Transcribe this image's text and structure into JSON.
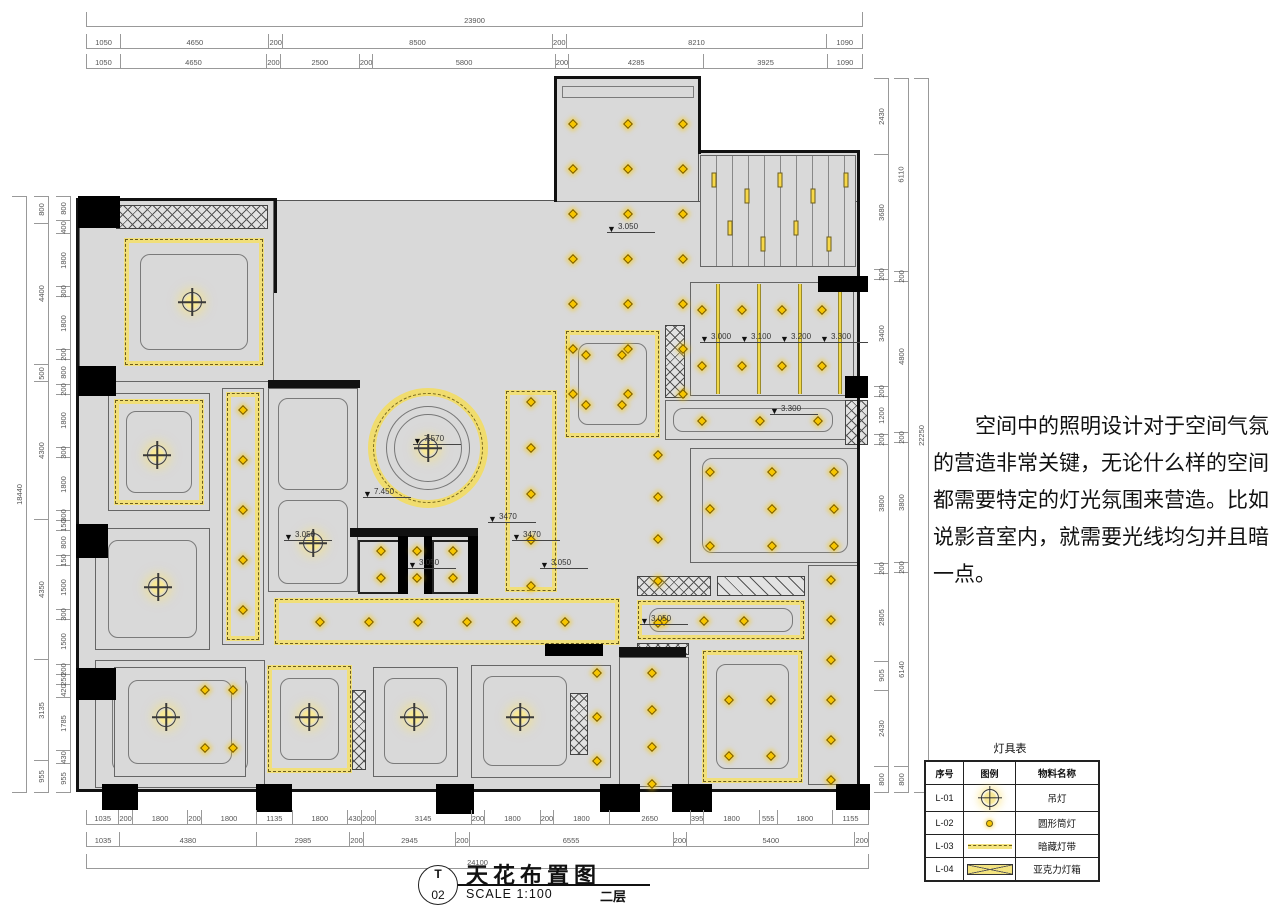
{
  "title_block": {
    "sheet_letter": "T",
    "sheet_number": "02",
    "title": "天花布置图",
    "scale": "SCALE 1:100",
    "floor": "二层"
  },
  "note": {
    "text": "空间中的照明设计对于空间气氛的营造非常关键，无论什么样的空间都需要特定的灯光氛围来营造。比如说影音室内，就需要光线均匀并且暗一点。"
  },
  "legend": {
    "title": "灯具表",
    "headers": [
      "序号",
      "图例",
      "物料名称"
    ],
    "rows": [
      {
        "id": "L-01",
        "symbol": "pendant-light",
        "name": "吊灯"
      },
      {
        "id": "L-02",
        "symbol": "round-downlight",
        "name": "圆形筒灯"
      },
      {
        "id": "L-03",
        "symbol": "concealed-light-strip",
        "name": "暗藏灯带"
      },
      {
        "id": "L-04",
        "symbol": "acrylic-light-box",
        "name": "亚克力灯箱"
      }
    ]
  },
  "dimensions": {
    "top": {
      "total": "23900",
      "row2": [
        1050,
        4650,
        200,
        8500,
        200,
        8210,
        1090
      ],
      "row3": [
        1050,
        4650,
        200,
        2500,
        200,
        5800,
        200,
        4285,
        3925,
        1090
      ]
    },
    "bottom": {
      "row1": [
        1035,
        200,
        1800,
        200,
        1800,
        1135,
        1800,
        430,
        200,
        3145,
        200,
        1800,
        200,
        1800,
        2650,
        395,
        1800,
        555,
        1800,
        1155
      ],
      "row2": [
        1035,
        4380,
        2985,
        200,
        2945,
        200,
        6555,
        200,
        5400,
        200
      ],
      "total": "24100"
    },
    "left": {
      "total": "18440",
      "mid": [
        800,
        4400,
        500,
        4300,
        4350,
        3135,
        955
      ],
      "inner": [
        800,
        400,
        1800,
        300,
        1800,
        200,
        800,
        200,
        1800,
        300,
        1800,
        300,
        150,
        800,
        150,
        1500,
        300,
        1500,
        200,
        250,
        420,
        1785,
        430,
        955
      ]
    },
    "right": {
      "total": "22250",
      "mid": [
        6110,
        200,
        4800,
        200,
        3800,
        200,
        6140,
        800
      ],
      "inner": [
        2430,
        3680,
        200,
        3400,
        200,
        1200,
        200,
        3800,
        200,
        2805,
        905,
        2430,
        800
      ]
    }
  },
  "plan": {
    "elevation_markers": [
      {
        "x": 607,
        "y": 222,
        "label": "3.050"
      },
      {
        "x": 413,
        "y": 434,
        "label": "7.570"
      },
      {
        "x": 363,
        "y": 487,
        "label": "7.450"
      },
      {
        "x": 284,
        "y": 530,
        "label": "3.050"
      },
      {
        "x": 408,
        "y": 558,
        "label": "3.050"
      },
      {
        "x": 488,
        "y": 512,
        "label": "3470"
      },
      {
        "x": 512,
        "y": 530,
        "label": "3470"
      },
      {
        "x": 540,
        "y": 558,
        "label": "3.050"
      },
      {
        "x": 700,
        "y": 332,
        "label": "3.000"
      },
      {
        "x": 740,
        "y": 332,
        "label": "3.100"
      },
      {
        "x": 780,
        "y": 332,
        "label": "3.200"
      },
      {
        "x": 820,
        "y": 332,
        "label": "3.300"
      },
      {
        "x": 770,
        "y": 404,
        "label": "3.300"
      },
      {
        "x": 640,
        "y": 614,
        "label": "3.050"
      }
    ],
    "pendants": [
      [
        192,
        302
      ],
      [
        157,
        455
      ],
      [
        158,
        587
      ],
      [
        166,
        717
      ],
      [
        313,
        543
      ],
      [
        309,
        717
      ],
      [
        414,
        717
      ],
      [
        520,
        717
      ],
      [
        428,
        448
      ]
    ],
    "downlight_groups": [
      {
        "x0": 573,
        "y0": 124,
        "dx": 55,
        "dy": 45,
        "nx": 3,
        "ny": 7
      },
      {
        "x0": 702,
        "y0": 310,
        "dx": 40,
        "dy": 56,
        "nx": 4,
        "ny": 2
      },
      {
        "x0": 702,
        "y0": 421,
        "dx": 58,
        "dy": 0,
        "nx": 3,
        "ny": 1
      },
      {
        "x0": 586,
        "y0": 355,
        "dx": 36,
        "dy": 50,
        "nx": 2,
        "ny": 2
      },
      {
        "x0": 243,
        "y0": 410,
        "dx": 0,
        "dy": 50,
        "nx": 1,
        "ny": 5
      },
      {
        "x0": 531,
        "y0": 402,
        "dx": 0,
        "dy": 46,
        "nx": 1,
        "ny": 5
      },
      {
        "x0": 320,
        "y0": 622,
        "dx": 49,
        "dy": 0,
        "nx": 6,
        "ny": 1
      },
      {
        "x0": 664,
        "y0": 621,
        "dx": 40,
        "dy": 0,
        "nx": 3,
        "ny": 1
      },
      {
        "x0": 710,
        "y0": 472,
        "dx": 62,
        "dy": 37,
        "nx": 3,
        "ny": 3
      },
      {
        "x0": 658,
        "y0": 455,
        "dx": 0,
        "dy": 42,
        "nx": 1,
        "ny": 5
      },
      {
        "x0": 205,
        "y0": 690,
        "dx": 28,
        "dy": 58,
        "nx": 2,
        "ny": 2
      },
      {
        "x0": 597,
        "y0": 673,
        "dx": 0,
        "dy": 44,
        "nx": 1,
        "ny": 3
      },
      {
        "x0": 652,
        "y0": 673,
        "dx": 0,
        "dy": 37,
        "nx": 1,
        "ny": 4
      },
      {
        "x0": 729,
        "y0": 700,
        "dx": 42,
        "dy": 56,
        "nx": 2,
        "ny": 2
      },
      {
        "x0": 831,
        "y0": 580,
        "dx": 0,
        "dy": 40,
        "nx": 1,
        "ny": 6
      },
      {
        "x0": 381,
        "y0": 551,
        "dx": 36,
        "dy": 27,
        "nx": 3,
        "ny": 2
      }
    ],
    "bar_light_groups": [
      {
        "x0": 714,
        "y0": 180,
        "dx": 33,
        "nx": 5
      },
      {
        "x0": 730,
        "y0": 228,
        "dx": 33,
        "nx": 4
      }
    ]
  },
  "colors": {
    "accent_yellow": "#f1df79",
    "lamp_yellow": "#f7c600",
    "room_fill": "#d9d9d9",
    "wall_black": "#000000",
    "line_gray": "#666666"
  }
}
